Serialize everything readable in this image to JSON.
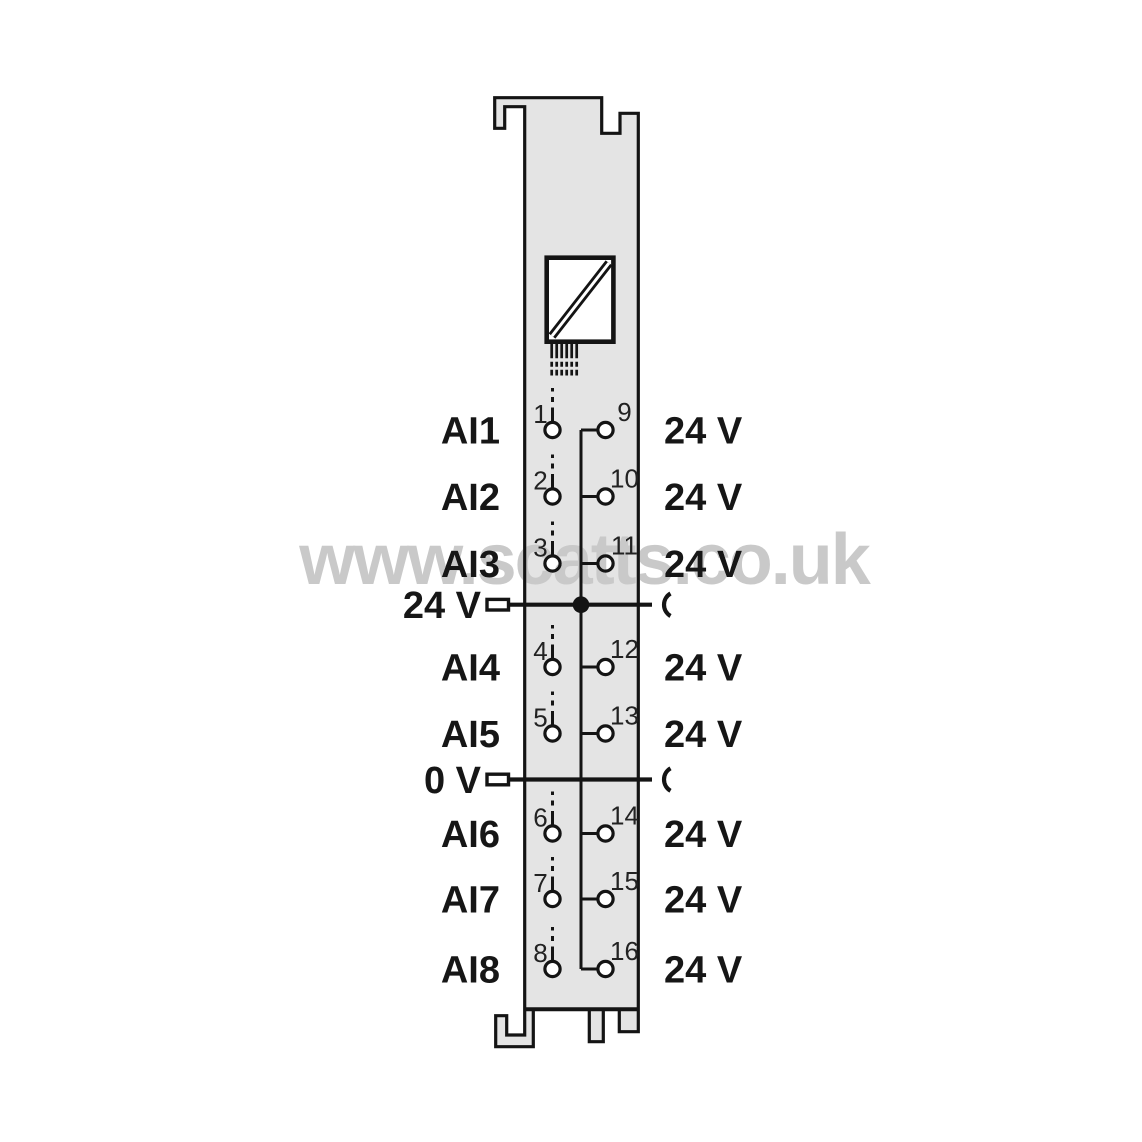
{
  "watermark": {
    "text": "www.scatts.co.uk",
    "color": "#c9c9c9"
  },
  "module": {
    "body_color": "#e4e4e4",
    "line_color": "#141414",
    "converter_icon": "analog-converter-icon",
    "rows": [
      {
        "signal": "AI1",
        "left_pin": "1",
        "right_pin": "9",
        "right_label": "24 V"
      },
      {
        "signal": "AI2",
        "left_pin": "2",
        "right_pin": "10",
        "right_label": "24 V"
      },
      {
        "signal": "AI3",
        "left_pin": "3",
        "right_pin": "11",
        "right_label": "24 V"
      },
      {
        "signal": "AI4",
        "left_pin": "4",
        "right_pin": "12",
        "right_label": "24 V"
      },
      {
        "signal": "AI5",
        "left_pin": "5",
        "right_pin": "13",
        "right_label": "24 V"
      },
      {
        "signal": "AI6",
        "left_pin": "6",
        "right_pin": "14",
        "right_label": "24 V"
      },
      {
        "signal": "AI7",
        "left_pin": "7",
        "right_pin": "15",
        "right_label": "24 V"
      },
      {
        "signal": "AI8",
        "left_pin": "8",
        "right_pin": "16",
        "right_label": "24 V"
      }
    ],
    "power_rails": [
      {
        "label": "24 V"
      },
      {
        "label": "0 V"
      }
    ]
  }
}
